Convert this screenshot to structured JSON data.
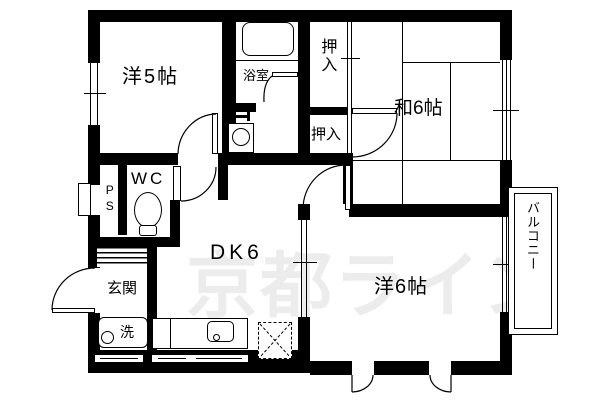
{
  "rooms": {
    "western5": "洋5帖",
    "bathroom": "浴室",
    "closet_top": "押入",
    "closet_bottom": "押入",
    "japanese6": "和6帖",
    "wc": "WC",
    "pipe_space": "PS",
    "dining_kitchen": "DK6",
    "entrance": "玄関",
    "laundry": "洗",
    "western6": "洋6帖",
    "balcony": "バルコニー"
  },
  "watermark": "京都ライン",
  "colors": {
    "wall": "#000000",
    "background": "#ffffff",
    "watermark": "#ececec"
  }
}
